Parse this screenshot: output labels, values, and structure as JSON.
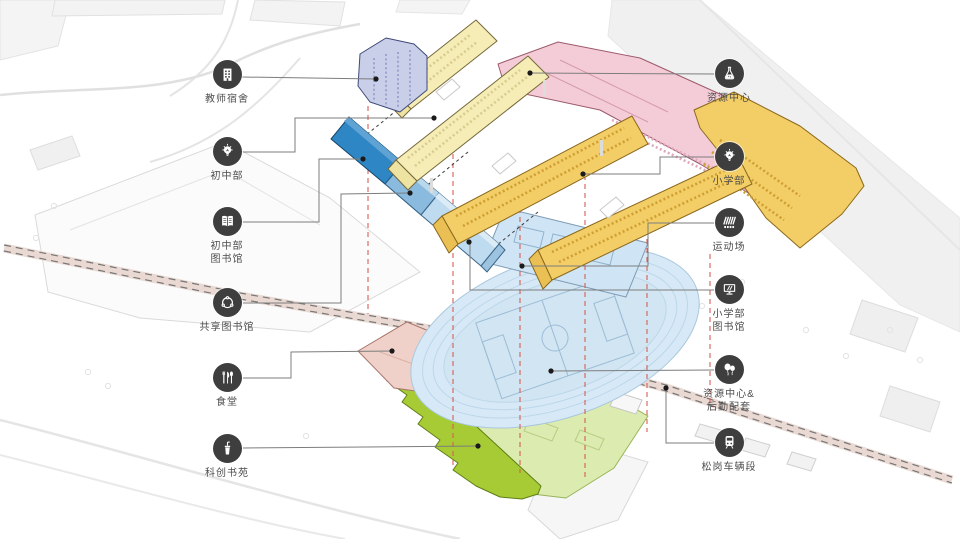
{
  "page": {
    "type": "architectural-site-callout-diagram",
    "background": "#ffffff"
  },
  "palette": {
    "icon_badge": "#3e3e3e",
    "label_text": "#4c4c4c",
    "leader_line": "#7d7d7d",
    "anchor_dot": "#1a1a1a",
    "projection_red": "#d65f52",
    "teacher_dorm_lavender": "#c9cfe8",
    "classroom_pale_yellow": "#f5ecb6",
    "primary_gold": "#f3ce67",
    "resource_pink": "#f4ccd7",
    "library_dark_blue": "#2f86c4",
    "library_mid_blue": "#8abade",
    "library_light_blue": "#bedbef",
    "sports_track_blue": "#d7e9f6",
    "sports_courts_blue": "#cfe5f5",
    "logistics_green": "#dcebaf",
    "book_garden_green": "#a7cb35",
    "canteen_pink": "#efd1c9"
  },
  "callouts": [
    {
      "id": "teacher-dorm",
      "side": "left",
      "icon": "building-icon",
      "lines": [
        "教师宿舍"
      ]
    },
    {
      "id": "middle-school",
      "side": "left",
      "icon": "bulb-icon",
      "lines": [
        "初中部"
      ]
    },
    {
      "id": "middle-school-library",
      "side": "left",
      "icon": "book-icon",
      "lines": [
        "初中部",
        "图书馆"
      ]
    },
    {
      "id": "shared-library",
      "side": "left",
      "icon": "share-icon",
      "lines": [
        "共享图书馆"
      ]
    },
    {
      "id": "canteen",
      "side": "left",
      "icon": "utensils-icon",
      "lines": [
        "食堂"
      ]
    },
    {
      "id": "science-book-garden",
      "side": "left",
      "icon": "drink-icon",
      "lines": [
        "科创书苑"
      ]
    },
    {
      "id": "resource-center",
      "side": "right",
      "icon": "flask-icon",
      "lines": [
        "资源中心"
      ]
    },
    {
      "id": "primary-school",
      "side": "right",
      "icon": "bulb-icon",
      "lines": [
        "小学部"
      ]
    },
    {
      "id": "sports-field",
      "side": "right",
      "icon": "track-icon",
      "lines": [
        "运动场"
      ]
    },
    {
      "id": "primary-school-library",
      "side": "right",
      "icon": "monitor-icon",
      "lines": [
        "小学部",
        "图书馆"
      ]
    },
    {
      "id": "resource-logistics",
      "side": "right",
      "icon": "balloons-icon",
      "lines": [
        "资源中心&",
        "后勤配套"
      ]
    },
    {
      "id": "songgang-depot",
      "side": "right",
      "icon": "train-icon",
      "lines": [
        "松岗车辆段"
      ]
    }
  ]
}
